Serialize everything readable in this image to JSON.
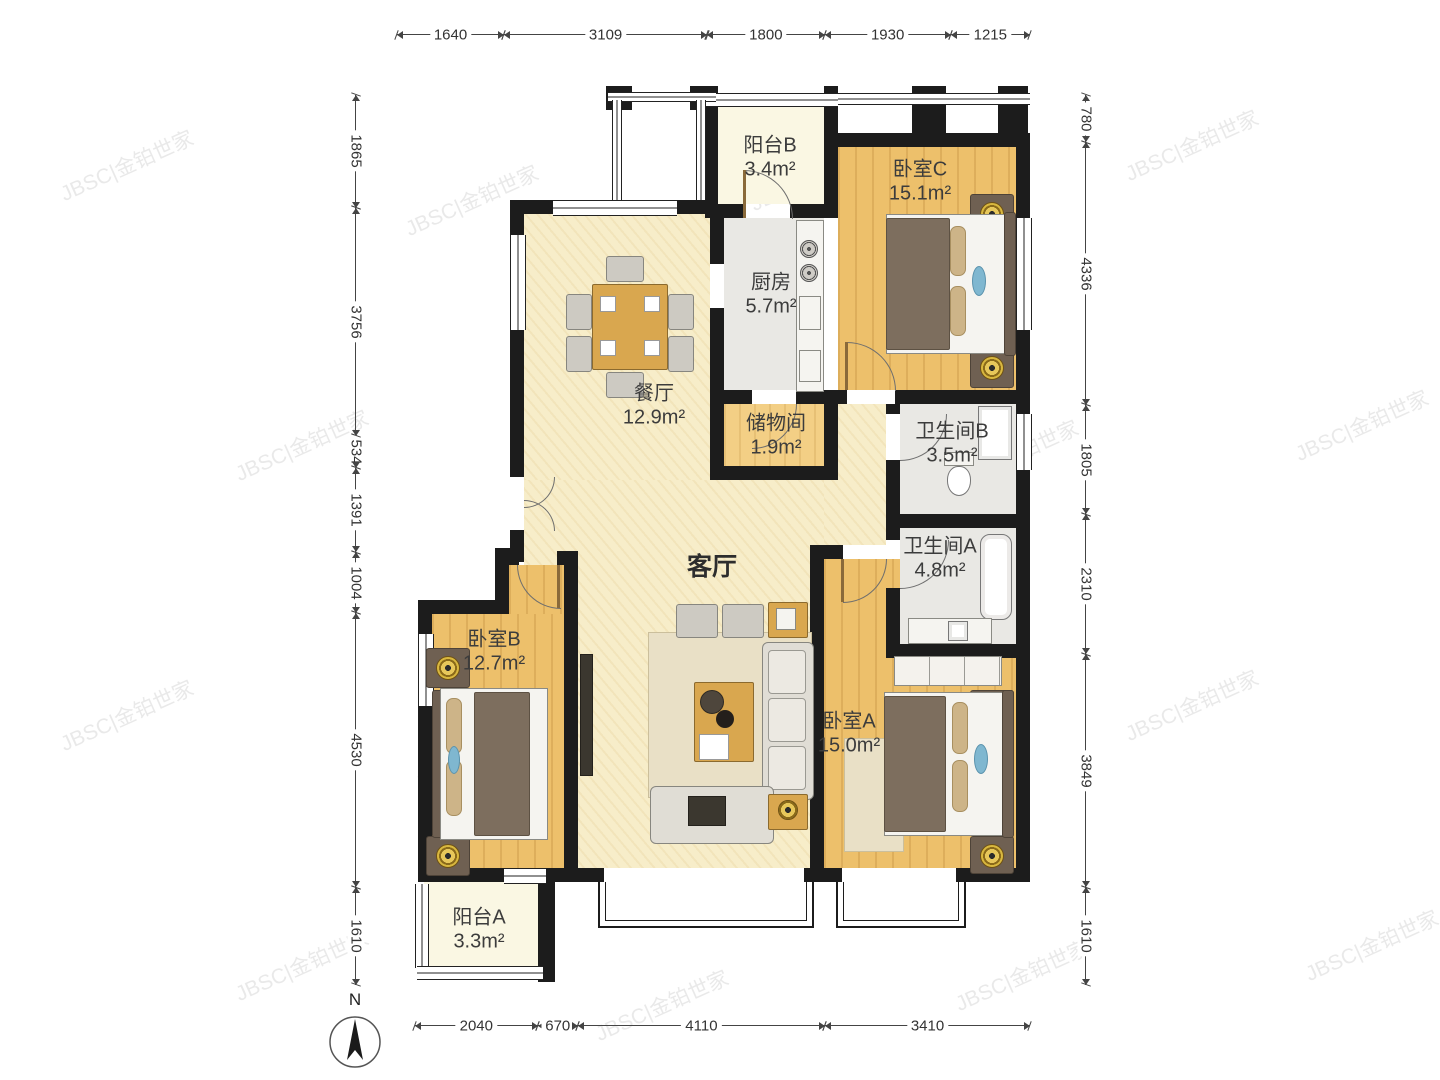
{
  "watermark": {
    "text": "JBSC|金铂世家"
  },
  "compass": {
    "label": "N"
  },
  "rooms": {
    "balcony_b": {
      "name": "阳台B",
      "area": "3.4m²"
    },
    "bedroom_c": {
      "name": "卧室C",
      "area": "15.1m²"
    },
    "kitchen": {
      "name": "厨房",
      "area": "5.7m²"
    },
    "dining": {
      "name": "餐厅",
      "area": "12.9m²"
    },
    "storage": {
      "name": "储物间",
      "area": "1.9m²"
    },
    "bath_b": {
      "name": "卫生间B",
      "area": "3.5m²"
    },
    "bath_a": {
      "name": "卫生间A",
      "area": "4.8m²"
    },
    "living": {
      "name": "客厅",
      "area": ""
    },
    "bedroom_b": {
      "name": "卧室B",
      "area": "12.7m²"
    },
    "bedroom_a": {
      "name": "卧室A",
      "area": "15.0m²"
    },
    "balcony_a": {
      "name": "阳台A",
      "area": "3.3m²"
    }
  },
  "dimensions": {
    "top": {
      "values": [
        1640,
        3109,
        1800,
        1930,
        1215
      ]
    },
    "bottom": {
      "values": [
        2040,
        670,
        4110,
        3410
      ]
    },
    "left": {
      "values": [
        1865,
        3756,
        534,
        1391,
        1004,
        4530,
        1610
      ]
    },
    "right": {
      "values": [
        780,
        4336,
        1805,
        2310,
        3849,
        1610
      ]
    }
  },
  "colors": {
    "wall": "#1c1c1c",
    "wood_floor": "#EDC06B",
    "cream_floor": "#F7EDC9",
    "gray_floor": "#E9E8E4",
    "balcony_floor": "#FAF7E3",
    "dimension_text": "#333333"
  }
}
